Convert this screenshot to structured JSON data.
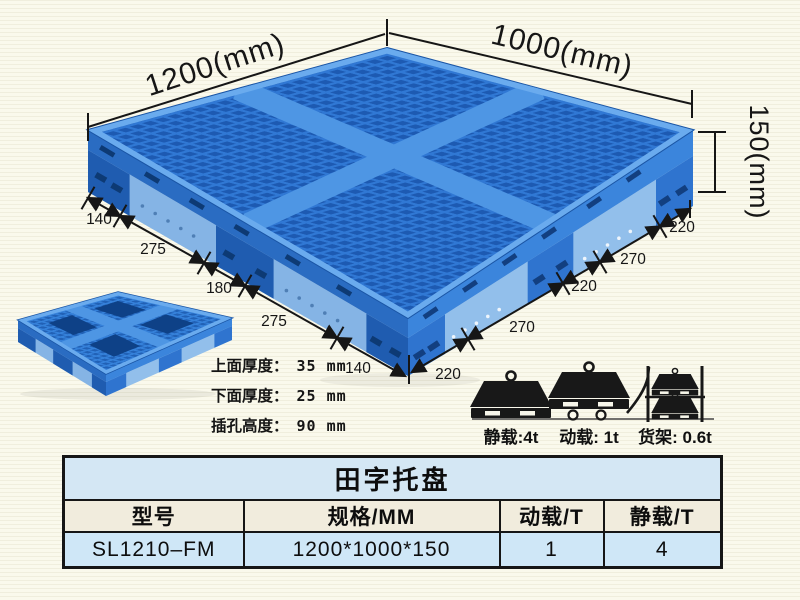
{
  "diagram": {
    "length_label": "1200(mm)",
    "width_label": "1000(mm)",
    "height_label": "150(mm)",
    "left_dims": [
      "140",
      "275",
      "180",
      "275",
      "140"
    ],
    "right_dims": [
      "220",
      "270",
      "220",
      "270",
      "220"
    ],
    "notes": [
      {
        "label": "上面厚度：",
        "value": "35 mm"
      },
      {
        "label": "下面厚度：",
        "value": "25 mm"
      },
      {
        "label": "插孔高度：",
        "value": "90 mm"
      }
    ],
    "loads": [
      {
        "icon": "static-load-icon",
        "label": "静载:4t"
      },
      {
        "icon": "trolley-load-icon",
        "label": "动载: 1t"
      },
      {
        "icon": "rack-load-icon",
        "label": "货架: 0.6t"
      }
    ]
  },
  "table": {
    "title": "田字托盘",
    "columns": [
      "型号",
      "规格/MM",
      "动载/T",
      "静载/T"
    ],
    "row": {
      "model": "SL1210–FM",
      "spec": "1200*1000*150",
      "dynamic_load": "1",
      "static_load": "4"
    }
  },
  "colors": {
    "pallet_blue": "#3078d4",
    "pallet_hole_blue": "#1d5ab2",
    "pallet_skirt_blue": "#85b4e5",
    "table_title_bg": "#d4e7f4",
    "table_header_bg": "#f1ecdd",
    "table_row_bg": "#cfe7f7",
    "background": "#faf9ec",
    "line": "#161616"
  }
}
